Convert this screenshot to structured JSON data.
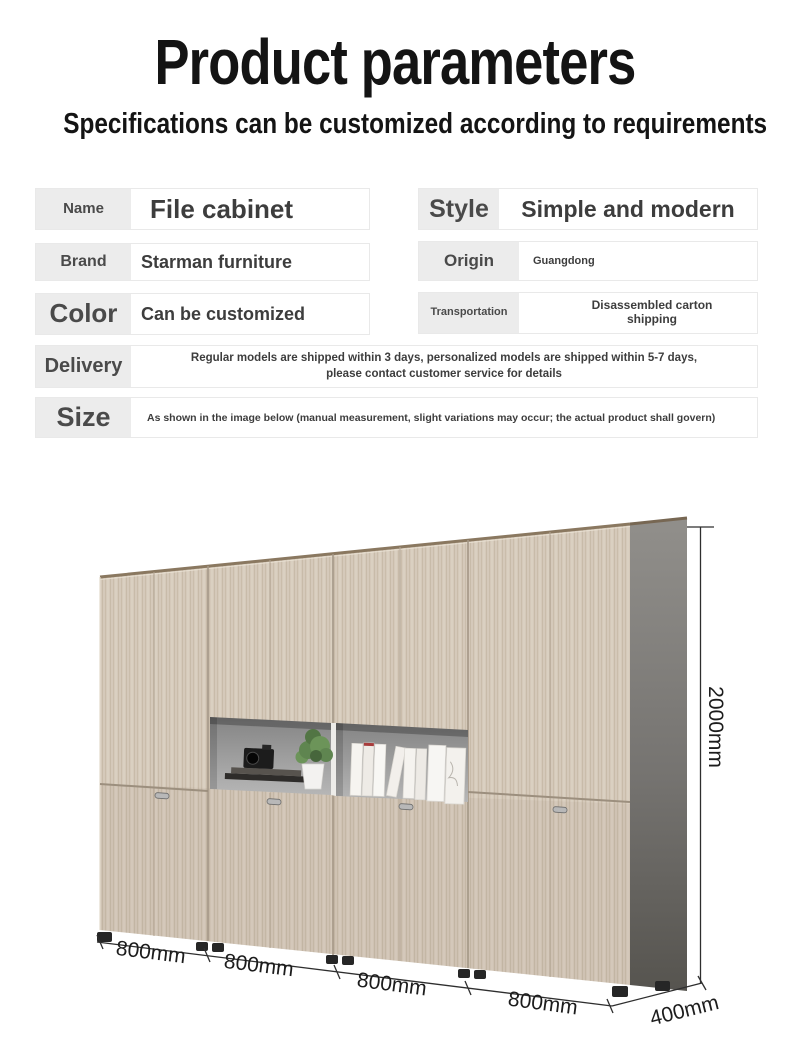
{
  "page": {
    "title": "Product parameters",
    "subtitle": "Specifications can be customized according to requirements"
  },
  "specs": {
    "name": {
      "label": "Name",
      "value": "File cabinet"
    },
    "style": {
      "label": "Style",
      "value": "Simple and modern"
    },
    "brand": {
      "label": "Brand",
      "value": "Starman furniture"
    },
    "origin": {
      "label": "Origin",
      "value": "Guangdong"
    },
    "color": {
      "label": "Color",
      "value": "Can be customized"
    },
    "transportation": {
      "label": "Transportation",
      "value": "Disassembled carton shipping"
    },
    "delivery": {
      "label": "Delivery",
      "value": "Regular models are shipped within 3 days, personalized models are shipped within 5-7 days, please contact customer service for details"
    },
    "size": {
      "label": "Size",
      "value": "As shown in the image below (manual measurement, slight variations may occur; the actual product shall govern)"
    }
  },
  "diagram": {
    "product": "file-cabinet-illustration",
    "width_labels": [
      "800mm",
      "800mm",
      "800mm",
      "800mm"
    ],
    "depth_label": "400mm",
    "height_label": "2000mm",
    "colors": {
      "wood": "#d5c9ba",
      "side_panel": "#6e6b66",
      "niche": "#9b9b9b",
      "dimension_line": "#2e2e2e"
    }
  }
}
